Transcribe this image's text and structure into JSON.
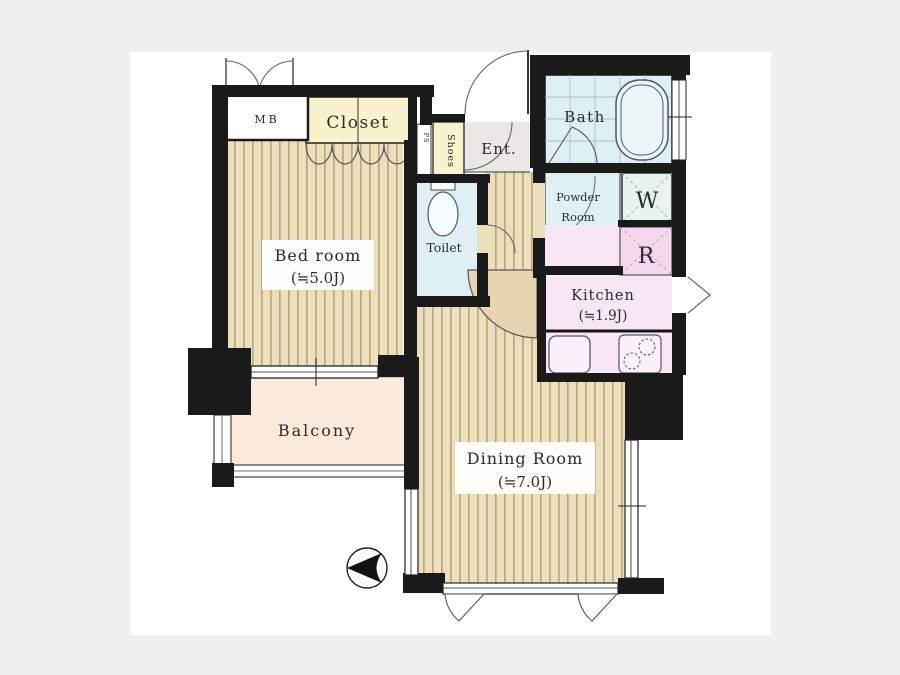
{
  "title": "Apartment floor plan",
  "background": {
    "page_bg": "#f0f0ef",
    "canvas_bg": "#ffffff"
  },
  "colors": {
    "wall": "#1a1a1a",
    "floor_base": "#ecdfbe",
    "floor_stripe": "#bda87e",
    "closet": "#f8f3cd",
    "shoes": "#f8f3cd",
    "entrance": "#e9e8e4",
    "bath": "#def0f3",
    "toilet": "#def0f3",
    "powder": "#def0f3",
    "washer": "#e7f3ec",
    "fridge": "#f5d7ee",
    "kitchen": "#f9e6f5",
    "balcony": "#fbead9",
    "door_fill": "#e7d4b2"
  },
  "rooms": {
    "bedroom": {
      "label": "Bed room",
      "size": "(≒5.0J)"
    },
    "dining_room": {
      "label": "Dining Room",
      "size": "(≒7.0J)"
    },
    "kitchen": {
      "label": "Kitchen",
      "size": "(≒1.9J)"
    },
    "balcony": {
      "label": "Balcony"
    },
    "bath": {
      "label": "Bath"
    },
    "toilet": {
      "label": "Toilet"
    },
    "powder_room": {
      "label_line1": "Powder",
      "label_line2": "Room"
    },
    "entrance": {
      "label": "Ent."
    },
    "closet": {
      "label": "Closet"
    },
    "shoe_cabinet": {
      "label": "Shoes"
    },
    "meter_box": {
      "label": "MB"
    },
    "pipe_space": {
      "label": "PS"
    },
    "washer_space": {
      "label": "W"
    },
    "refrigerator_space": {
      "label": "R"
    }
  }
}
